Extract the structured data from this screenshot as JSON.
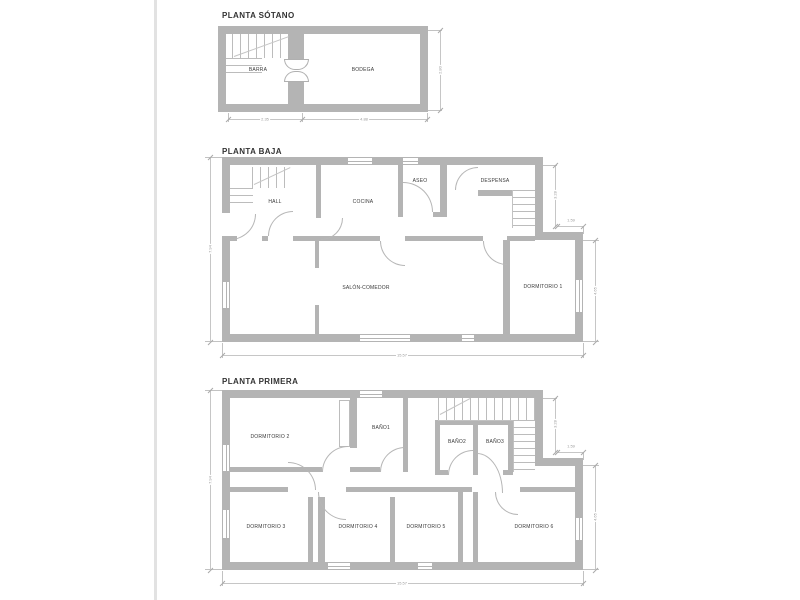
{
  "colors": {
    "wall": "#b4b4b4",
    "thin_line": "#c2c2c2",
    "label_text": "#3a3a3a",
    "dim_text": "#9a9a9a",
    "page_edge": "#e2e2e2"
  },
  "floors": [
    {
      "title": "PLANTA SÓTANO",
      "rooms": [
        {
          "label": "BARRA"
        },
        {
          "label": "BODEGA"
        }
      ],
      "dims": {
        "width_left": "2.35",
        "width_right": "4.88",
        "height_right": "2.80"
      }
    },
    {
      "title": "PLANTA BAJA",
      "rooms": [
        {
          "label": "HALL"
        },
        {
          "label": "COCINA"
        },
        {
          "label": "ASEO"
        },
        {
          "label": "DESPENSA"
        },
        {
          "label": "SALÓN-COMEDOR"
        },
        {
          "label": "DORMITORIO 1"
        }
      ],
      "dims": {
        "left": "7.94",
        "bottom": "15.57",
        "right_upper": "3.28",
        "notch": "1.59",
        "right_lower": "4.65"
      }
    },
    {
      "title": "PLANTA PRIMERA",
      "rooms": [
        {
          "label": "DORMITORIO 2"
        },
        {
          "label": "BAÑO1"
        },
        {
          "label": "BAÑO2"
        },
        {
          "label": "BAÑO3"
        },
        {
          "label": "DORMITORIO 3"
        },
        {
          "label": "DORMITORIO 4"
        },
        {
          "label": "DORMITORIO 5"
        },
        {
          "label": "DORMITORIO 6"
        }
      ],
      "dims": {
        "left": "7.94",
        "bottom": "15.57",
        "right_upper": "3.28",
        "notch": "1.59",
        "right_lower": "4.65"
      }
    }
  ]
}
